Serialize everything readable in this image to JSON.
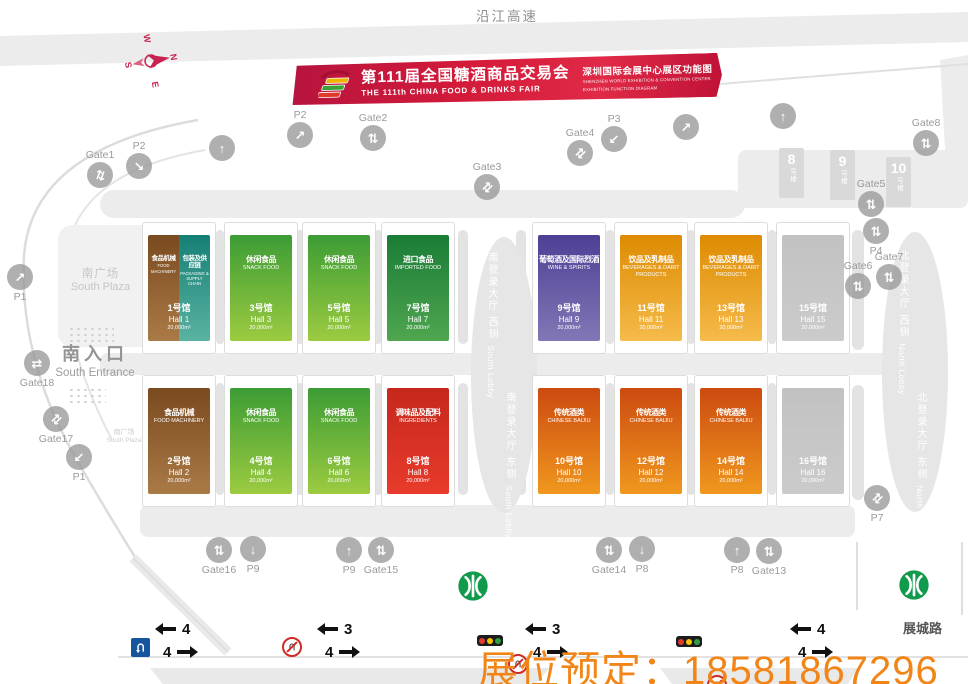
{
  "labels": {
    "top_road": "沿江高速",
    "bottom_road": "展城路",
    "hotline": "展位预定：18581867296",
    "south_plaza_cn": "南广场",
    "south_plaza_en": "South Plaza",
    "south_plaza2_cn": "南广场",
    "south_plaza2_en": "South Plaza",
    "south_entrance_cn": "南入口",
    "south_entrance_en": "South Entrance"
  },
  "banner": {
    "title_cn": "第111届全国糖酒商品交易会",
    "title_en": "THE 111th CHINA FOOD & DRINKS FAIR",
    "venue_cn": "深圳国际会展中心展区功能图",
    "venue_en1": "SHENZHEN WORLD EXHIBITION & CONVENTION CENTER",
    "venue_en2": "EXHIBITION FUNCTION DIAGRAM"
  },
  "compass": {
    "n": "N",
    "e": "E",
    "s": "S",
    "w": "W"
  },
  "palette": {
    "banner_red": "#d41a39",
    "hall_machinery": "#8a5526",
    "hall_packaging": "#2a9384",
    "hall_snack": "#58ab3a",
    "hall_imported": "#2c8a3e",
    "hall_wine": "#5c4fa0",
    "hall_beverage": "#e89a16",
    "hall_ingredients": "#d52f1f",
    "hall_baijiu": "#dd6a15",
    "hall_gray": "#c6c6c6",
    "metro_green": "#119a4c",
    "hotline_orange": "#f28518"
  },
  "halls": [
    {
      "no": 1,
      "name_cn": "食品机械",
      "name_en": "FOOD MACHINERY",
      "name2_cn": "包装及供应链",
      "name2_en": "PACKAGING & SUPPLY CHAIN",
      "hall_cn": "1号馆",
      "hall_en": "Hall 1",
      "area": "20,000m²",
      "cls": "cat-machinery",
      "cls2": "cat-packaging"
    },
    {
      "no": 2,
      "name_cn": "食品机械",
      "name_en": "FOOD MACHINERY",
      "hall_cn": "2号馆",
      "hall_en": "Hall 2",
      "area": "20,000m²",
      "cls": "cat-machinery"
    },
    {
      "no": 3,
      "name_cn": "休闲食品",
      "name_en": "SNACK FOOD",
      "hall_cn": "3号馆",
      "hall_en": "Hall 3",
      "area": "20,000m²",
      "cls": "cat-snack"
    },
    {
      "no": 4,
      "name_cn": "休闲食品",
      "name_en": "SNACK FOOD",
      "hall_cn": "4号馆",
      "hall_en": "Hall 4",
      "area": "20,000m²",
      "cls": "cat-snack"
    },
    {
      "no": 5,
      "name_cn": "休闲食品",
      "name_en": "SNACK FOOD",
      "hall_cn": "5号馆",
      "hall_en": "Hall 5",
      "area": "20,000m²",
      "cls": "cat-snack"
    },
    {
      "no": 6,
      "name_cn": "休闲食品",
      "name_en": "SNACK FOOD",
      "hall_cn": "6号馆",
      "hall_en": "Hall 6",
      "area": "20,000m²",
      "cls": "cat-snack"
    },
    {
      "no": 7,
      "name_cn": "进口食品",
      "name_en": "IMPORTED FOOD",
      "hall_cn": "7号馆",
      "hall_en": "Hall 7",
      "area": "20,000m²",
      "cls": "cat-imported"
    },
    {
      "no": 8,
      "name_cn": "调味品及配料",
      "name_en": "INGREDIENTS",
      "hall_cn": "8号馆",
      "hall_en": "Hall 8",
      "area": "20,000m²",
      "cls": "cat-ingredients"
    },
    {
      "no": 9,
      "name_cn": "葡萄酒及国际烈酒",
      "name_en": "WINE & SPIRITS",
      "hall_cn": "9号馆",
      "hall_en": "Hall 9",
      "area": "20,000m²",
      "cls": "cat-wine"
    },
    {
      "no": 10,
      "name_cn": "传统酒类",
      "name_en": "CHINESE BAIJIU",
      "hall_cn": "10号馆",
      "hall_en": "Hall 10",
      "area": "20,000m²",
      "cls": "cat-baijiu"
    },
    {
      "no": 11,
      "name_cn": "饮品及乳制品",
      "name_en": "BEVERAGES & DAIRT PRODUCTS",
      "hall_cn": "11号馆",
      "hall_en": "Hall 11",
      "area": "20,000m²",
      "cls": "cat-beverage"
    },
    {
      "no": 12,
      "name_cn": "传统酒类",
      "name_en": "CHINESE BAIJIU",
      "hall_cn": "12号馆",
      "hall_en": "Hall 12",
      "area": "20,000m²",
      "cls": "cat-baijiu"
    },
    {
      "no": 13,
      "name_cn": "饮品及乳制品",
      "name_en": "BEVERAGES & DAIRT PRODUCTS",
      "hall_cn": "13号馆",
      "hall_en": "Hall 13",
      "area": "20,000m²",
      "cls": "cat-beverage"
    },
    {
      "no": 14,
      "name_cn": "传统酒类",
      "name_en": "CHINESE BAIJIU",
      "hall_cn": "14号馆",
      "hall_en": "Hall 14",
      "area": "20,000m²",
      "cls": "cat-baijiu"
    },
    {
      "no": 15,
      "name_cn": "",
      "name_en": "",
      "hall_cn": "15号馆",
      "hall_en": "Hall 15",
      "area": "20,000m²",
      "cls": "cat-none"
    },
    {
      "no": 16,
      "name_cn": "",
      "name_en": "",
      "hall_cn": "16号馆",
      "hall_en": "Hall 16",
      "area": "20,000m²",
      "cls": "cat-none"
    }
  ],
  "lobbies": {
    "south_west_cn": "南登录大厅 西侧",
    "south_west_en": "South Lobby",
    "south_east_cn": "南登录大厅 东侧",
    "south_east_en": "South Lobby",
    "north_west_cn": "北登录大厅 西侧",
    "north_west_en": "North Lobby",
    "north_east_cn": "北登录大厅 东侧",
    "north_east_en": "North Lobby"
  },
  "buildings": [
    {
      "num": "8",
      "suffix": "号楼",
      "x": 779,
      "y": 148
    },
    {
      "num": "9",
      "suffix": "号楼",
      "x": 830,
      "y": 150
    },
    {
      "num": "10",
      "suffix": "号楼",
      "x": 886,
      "y": 157
    }
  ],
  "markers": [
    {
      "label": "Gate1",
      "glyph": "⇅",
      "x": 100,
      "y": 175,
      "lp": "above",
      "rot": 20
    },
    {
      "label": "P2",
      "glyph": "↘",
      "x": 139,
      "y": 166,
      "lp": "above",
      "rot": 0
    },
    {
      "label": "",
      "glyph": "↑",
      "x": 222,
      "y": 148,
      "lp": "none",
      "rot": 0
    },
    {
      "label": "P2",
      "glyph": "↗",
      "x": 300,
      "y": 135,
      "lp": "above",
      "rot": 0
    },
    {
      "label": "Gate2",
      "glyph": "⇅",
      "x": 373,
      "y": 138,
      "lp": "above",
      "rot": 0
    },
    {
      "label": "Gate3",
      "glyph": "⇅",
      "x": 487,
      "y": 187,
      "lp": "above",
      "rot": 45
    },
    {
      "label": "Gate4",
      "glyph": "⇅",
      "x": 580,
      "y": 153,
      "lp": "above",
      "rot": 45
    },
    {
      "label": "P3",
      "glyph": "↙",
      "x": 614,
      "y": 139,
      "lp": "above",
      "rot": 0
    },
    {
      "label": "",
      "glyph": "↗",
      "x": 686,
      "y": 127,
      "lp": "none",
      "rot": 0
    },
    {
      "label": "",
      "glyph": "↑",
      "x": 783,
      "y": 116,
      "lp": "none",
      "rot": 0
    },
    {
      "label": "Gate8",
      "glyph": "⇅",
      "x": 926,
      "y": 143,
      "lp": "above",
      "rot": 0
    },
    {
      "label": "Gate5",
      "glyph": "⇅",
      "x": 871,
      "y": 204,
      "lp": "above",
      "rot": 0
    },
    {
      "label": "P4",
      "glyph": "⇅",
      "x": 876,
      "y": 231,
      "lp": "below",
      "rot": 0
    },
    {
      "label": "Gate6",
      "glyph": "⇅",
      "x": 858,
      "y": 286,
      "lp": "above",
      "rot": 0
    },
    {
      "label": "Gate7",
      "glyph": "⇅",
      "x": 889,
      "y": 277,
      "lp": "above",
      "rot": 0
    },
    {
      "label": "P1",
      "glyph": "↗",
      "x": 20,
      "y": 277,
      "lp": "below",
      "rot": 0
    },
    {
      "label": "Gate18",
      "glyph": "⇄",
      "x": 37,
      "y": 363,
      "lp": "below",
      "rot": 0
    },
    {
      "label": "Gate17",
      "glyph": "⇅",
      "x": 56,
      "y": 419,
      "lp": "below",
      "rot": 45
    },
    {
      "label": "P1",
      "glyph": "↙",
      "x": 79,
      "y": 457,
      "lp": "below",
      "rot": 0
    },
    {
      "label": "Gate16",
      "glyph": "⇅",
      "x": 219,
      "y": 550,
      "lp": "below",
      "rot": 0
    },
    {
      "label": "P9",
      "glyph": "↓",
      "x": 253,
      "y": 549,
      "lp": "below",
      "rot": 0
    },
    {
      "label": "P9",
      "glyph": "↑",
      "x": 349,
      "y": 550,
      "lp": "below",
      "rot": 0
    },
    {
      "label": "Gate15",
      "glyph": "⇅",
      "x": 381,
      "y": 550,
      "lp": "below",
      "rot": 0
    },
    {
      "label": "Gate14",
      "glyph": "⇅",
      "x": 609,
      "y": 550,
      "lp": "below",
      "rot": 0
    },
    {
      "label": "P8",
      "glyph": "↓",
      "x": 642,
      "y": 549,
      "lp": "below",
      "rot": 0
    },
    {
      "label": "P8",
      "glyph": "↑",
      "x": 737,
      "y": 550,
      "lp": "below",
      "rot": 0
    },
    {
      "label": "Gate13",
      "glyph": "⇅",
      "x": 769,
      "y": 551,
      "lp": "below",
      "rot": 0
    },
    {
      "label": "P7",
      "glyph": "⇅",
      "x": 877,
      "y": 498,
      "lp": "below",
      "rot": 45
    }
  ],
  "traffic": [
    {
      "x": 160,
      "left": "4",
      "right": "4"
    },
    {
      "x": 322,
      "left": "3",
      "right": "4"
    },
    {
      "x": 530,
      "left": "3",
      "right": "4"
    },
    {
      "x": 795,
      "left": "4",
      "right": "4"
    }
  ],
  "metros": [
    {
      "x": 473,
      "y": 586
    },
    {
      "x": 914,
      "y": 585
    }
  ]
}
